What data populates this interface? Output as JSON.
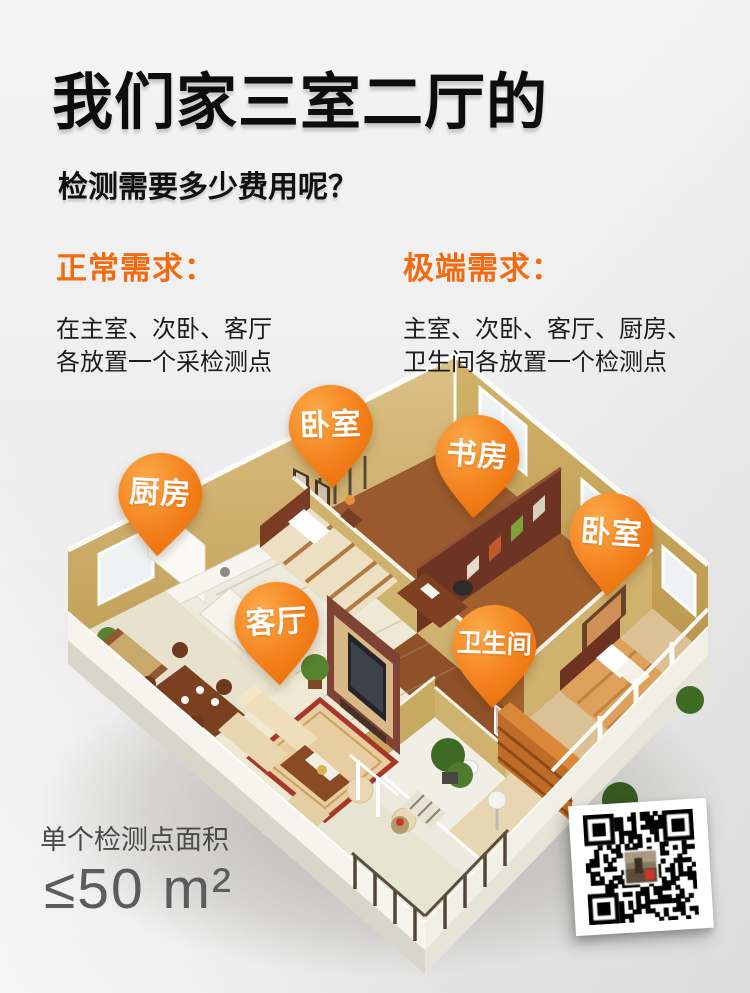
{
  "poster": {
    "background_color": "#efefef",
    "accent_color": "#f26b13",
    "pin_color": "#f58220",
    "description_icons": [
      "map-pin-icon",
      "qr-code"
    ]
  },
  "header": {
    "title": "我们家三室二厅的",
    "subtitle": "检测需要多少费用呢？"
  },
  "requirements": [
    {
      "heading": "正常需求：",
      "lines": [
        "在主室、次卧、客厅",
        "各放置一个采检测点"
      ]
    },
    {
      "heading": "极端需求：",
      "lines": [
        "主室、次卧、客厅、厨房、",
        "卫生间各放置一个检测点"
      ]
    }
  ],
  "pins": [
    {
      "room": "kitchen",
      "label": "厨房"
    },
    {
      "room": "bedroom-top",
      "label": "卧室"
    },
    {
      "room": "study",
      "label": "书房"
    },
    {
      "room": "bedroom-right",
      "label": "卧室"
    },
    {
      "room": "living-room",
      "label": "客厅"
    },
    {
      "room": "bathroom",
      "label": "卫生间"
    }
  ],
  "footer": {
    "area_label": "单个检测点面积",
    "area_value": "≤50 m²"
  }
}
